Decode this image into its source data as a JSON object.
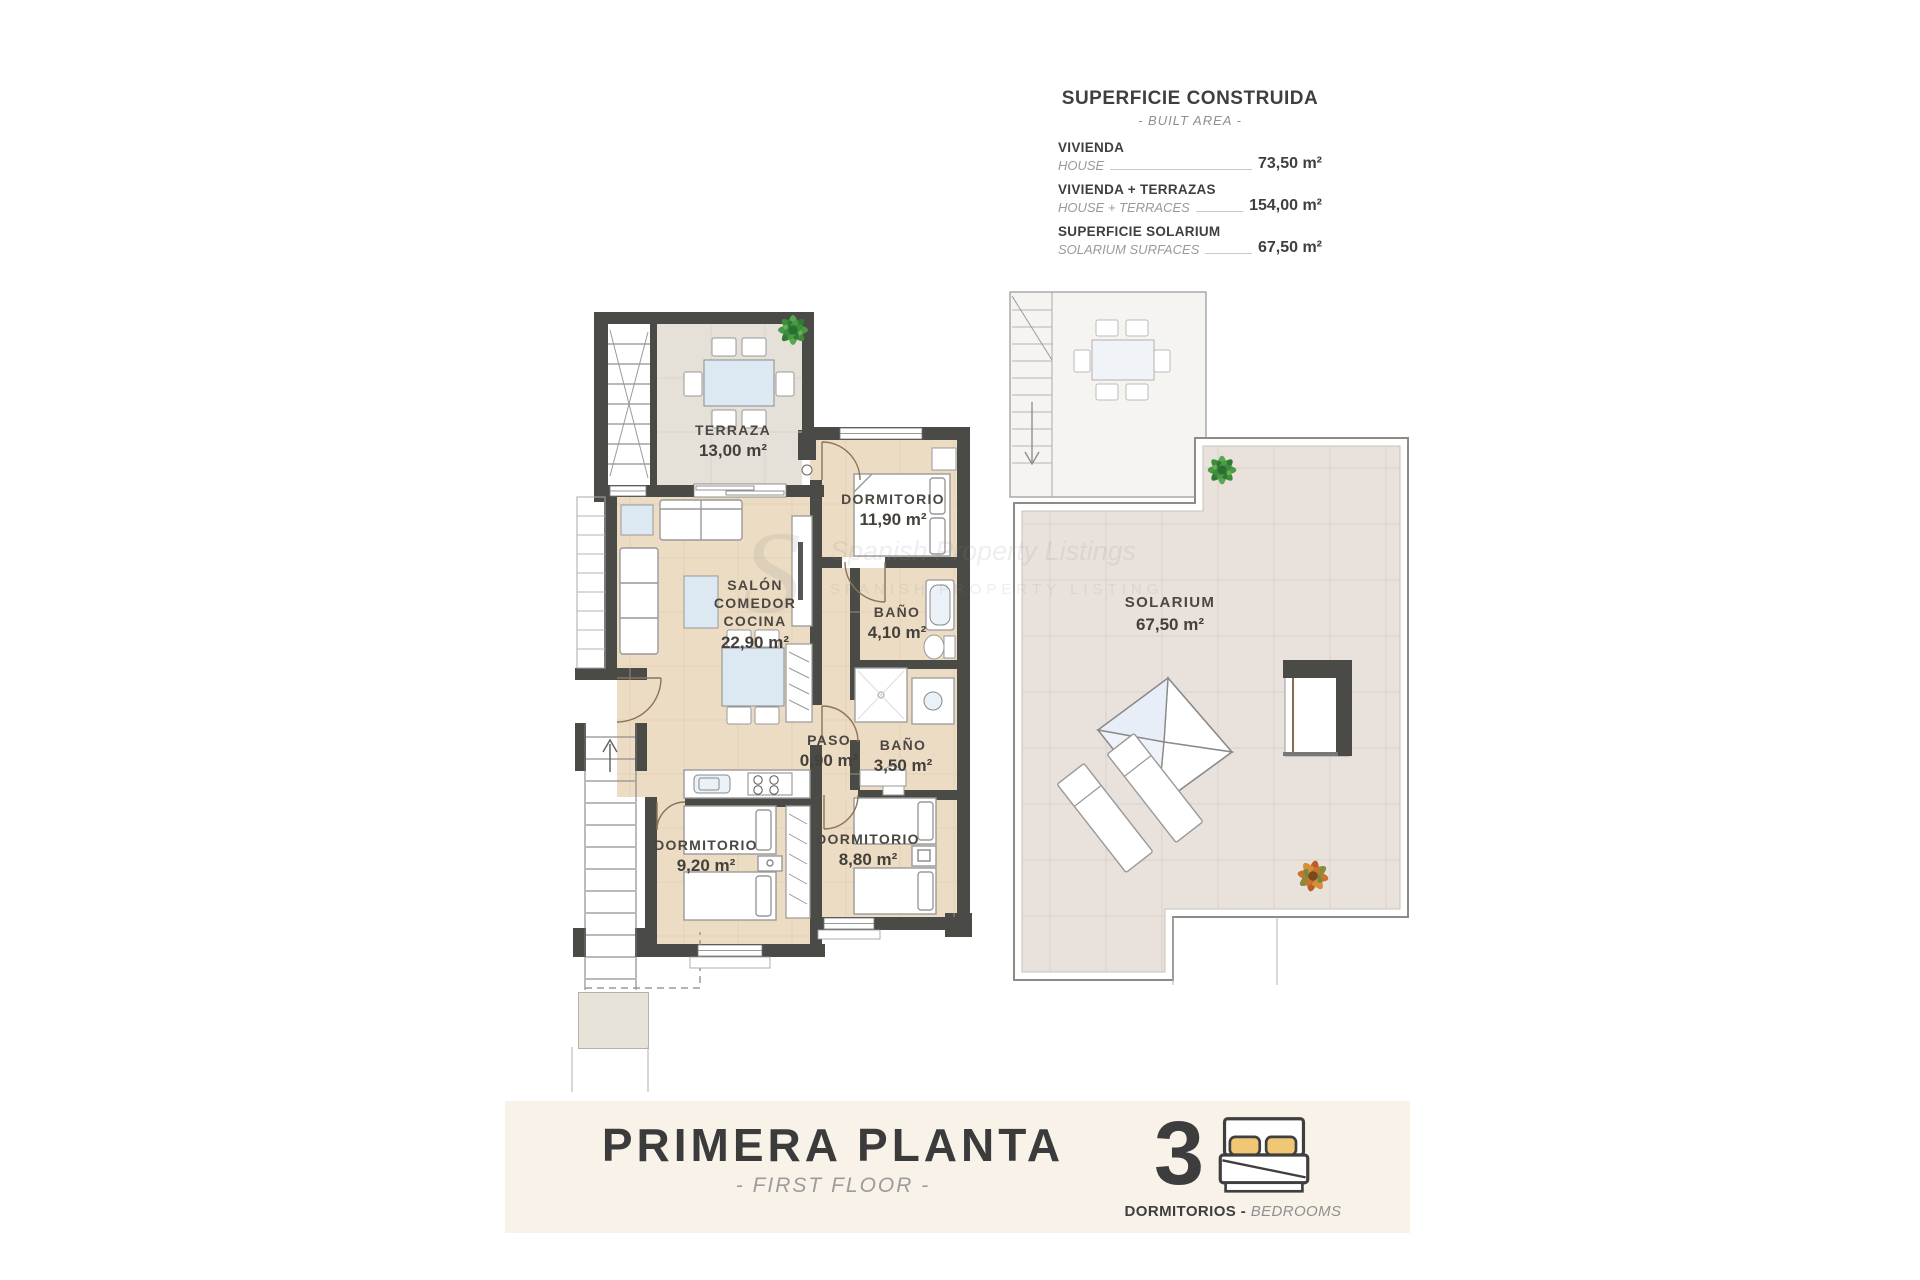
{
  "info_panel": {
    "title": "SUPERFICIE CONSTRUIDA",
    "subtitle": "- BUILT AREA -",
    "rows": [
      {
        "label": "VIVIENDA",
        "sublabel": "HOUSE",
        "value": "73,50 m²"
      },
      {
        "label": "VIVIENDA + TERRAZAS",
        "sublabel": "HOUSE + TERRACES",
        "value": "154,00 m²"
      },
      {
        "label": "SUPERFICIE SOLARIUM",
        "sublabel": "SOLARIUM SURFACES",
        "value": "67,50 m²"
      }
    ]
  },
  "rooms": {
    "terraza": {
      "name": "TERRAZA",
      "area": "13,00 m²"
    },
    "dormitorio_1": {
      "name": "DORMITORIO",
      "area": "11,90 m²"
    },
    "salon": {
      "name_line1": "SALÓN",
      "name_line2": "COMEDOR",
      "name_line3": "COCINA",
      "area": "22,90 m²"
    },
    "bano_1": {
      "name": "BAÑO",
      "area": "4,10 m²"
    },
    "paso": {
      "name": "PASO",
      "area": "0,90 m²"
    },
    "bano_2": {
      "name": "BAÑO",
      "area": "3,50 m²"
    },
    "dormitorio_2": {
      "name": "DORMITORIO",
      "area": "9,20 m²"
    },
    "dormitorio_3": {
      "name": "DORMITORIO",
      "area": "8,80 m²"
    },
    "solarium": {
      "name": "SOLARIUM",
      "area": "67,50 m²"
    }
  },
  "watermark": {
    "initial": "S",
    "line1": "Spanish Property Listings",
    "line2": "SPANISH PROPERTY LISTING"
  },
  "footer": {
    "title": "PRIMERA PLANTA",
    "subtitle": "- FIRST FLOOR -",
    "bedrooms_count": "3",
    "bedrooms_label": "DORMITORIOS",
    "bedrooms_separator": " - ",
    "bedrooms_sublabel": "BEDROOMS"
  },
  "colors": {
    "wall": "#4a4a47",
    "floor_beige": "#ecdcc3",
    "floor_terrace": "#e6e1d8",
    "floor_solarium": "#e9e1db",
    "banner_bg": "#f8f2e8",
    "pillow_accent": "#f0c873",
    "plant_green": "#4a9a44",
    "plant_orange": "#c8742e"
  }
}
